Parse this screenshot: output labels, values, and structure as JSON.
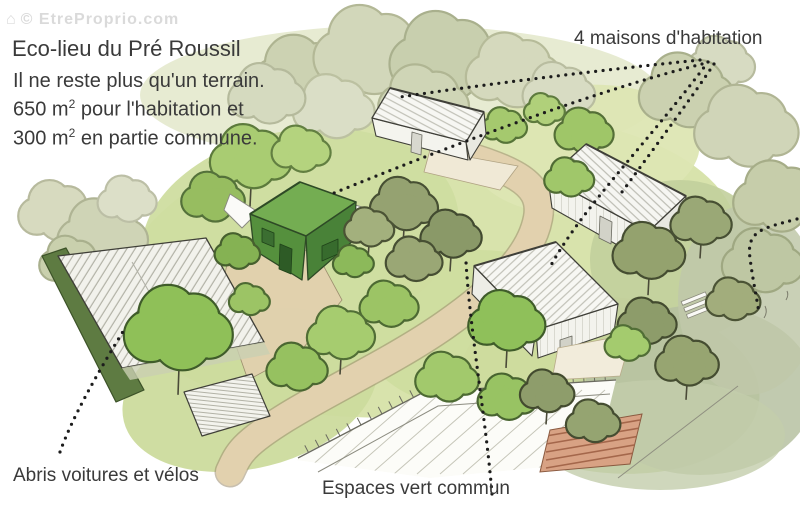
{
  "watermark": "© EtreProprio.com",
  "header": {
    "title": "Eco-lieu du Pré Roussil"
  },
  "info": {
    "line1": "Il ne reste plus qu'un terrain.",
    "area1_value": "650 m",
    "area1_sup": "2",
    "area1_rest": " pour l'habitation et",
    "area2_value": "300 m",
    "area2_sup": "2",
    "area2_rest": " en partie commune."
  },
  "annotations": {
    "houses_label": "4 maisons d'habitation",
    "shelter_label": "Abris voitures et vélos",
    "green_label": "Espaces vert commun"
  },
  "colors": {
    "annotation_text": "#3a3a3a",
    "leader_dots": "#1c1c1c",
    "watermark_gray": "#d2d2d2",
    "highlight_house_green": "#74ad52",
    "path_beige": "#e2d1ae",
    "garden_soil": "#d8a284",
    "foliage_bright": "#8fc058",
    "foliage_sage": "#ccd2b2"
  }
}
